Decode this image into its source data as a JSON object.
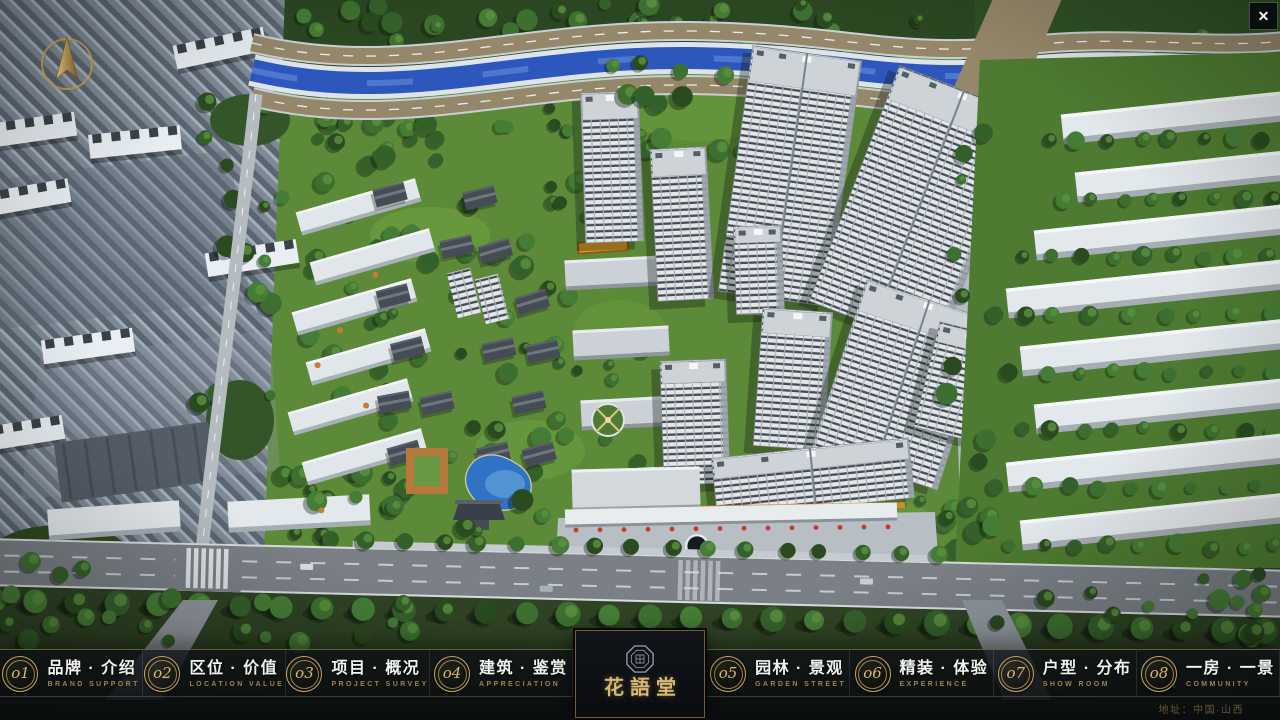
{
  "window": {
    "close_label": "✕"
  },
  "logo": {
    "name": "花語堂",
    "subtitle": "· · · · · · · · · ·"
  },
  "nav": {
    "items": [
      {
        "number": "o1",
        "label": "品牌 · 介绍",
        "subtitle": "BRAND SUPPORT"
      },
      {
        "number": "o2",
        "label": "区位 · 价值",
        "subtitle": "LOCATION VALUE"
      },
      {
        "number": "o3",
        "label": "项目 · 概况",
        "subtitle": "PROJECT SURVEY"
      },
      {
        "number": "o4",
        "label": "建筑 · 鉴赏",
        "subtitle": "APPRECIATION"
      },
      {
        "number": "o5",
        "label": "园林 · 景观",
        "subtitle": "GARDEN STREET"
      },
      {
        "number": "o6",
        "label": "精装 · 体验",
        "subtitle": "EXPERIENCE"
      },
      {
        "number": "o7",
        "label": "户型 · 分布",
        "subtitle": "SHOW ROOM"
      },
      {
        "number": "o8",
        "label": "一房 · 一景",
        "subtitle": "COMMUNITY"
      }
    ]
  },
  "footer": {
    "address": "地址：中国·山西"
  },
  "colors": {
    "accent_gold": "#c9a75f",
    "river_blue": "#2e57bd",
    "label_white": "#f2f3ef",
    "subtitle_gold": "#9c8150",
    "bar_bg": "#0a0c10",
    "foliage": "#35602a",
    "flag_red": "#c43a2d"
  }
}
